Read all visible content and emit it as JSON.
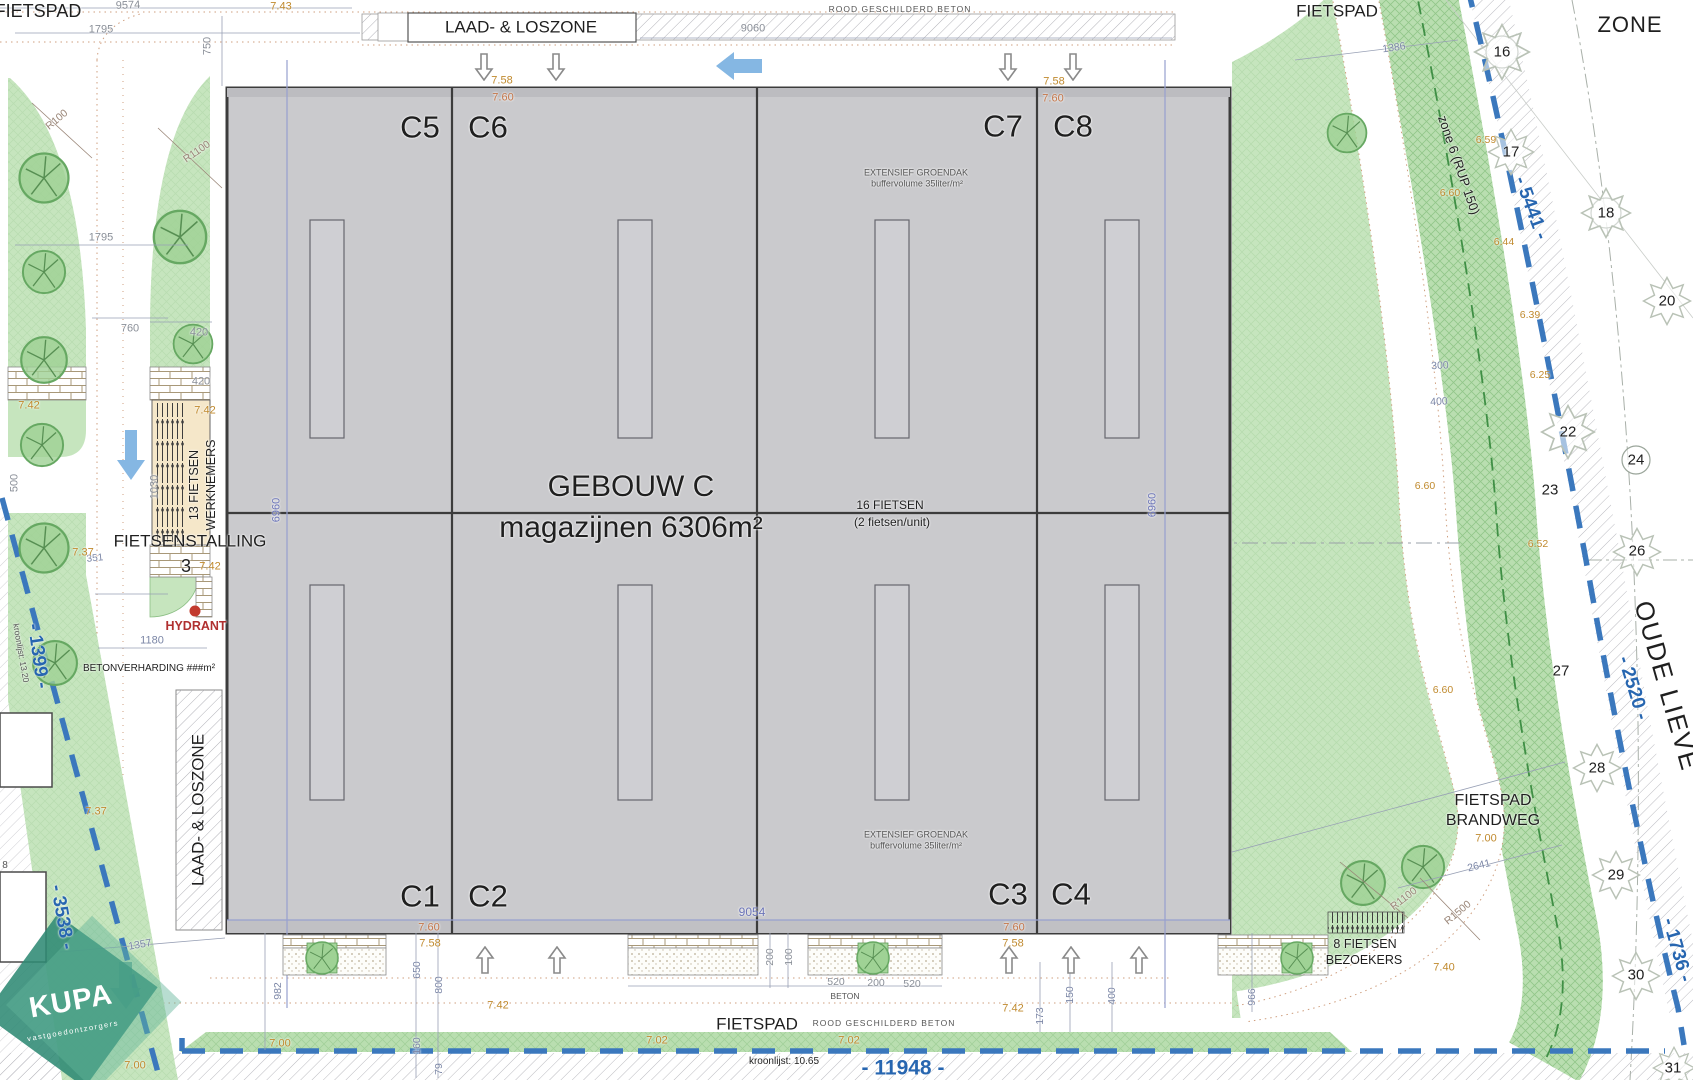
{
  "drawing": {
    "kind": "architectural site plan",
    "building_title": "GEBOUW C",
    "building_subtitle": "magazijnen 6306m²",
    "units": [
      "C1",
      "C2",
      "C3",
      "C4",
      "C5",
      "C6",
      "C7",
      "C8"
    ]
  },
  "colors": {
    "t": "#1f1f1f",
    "g": "#8a8f98",
    "gb": "#7b86a6",
    "b": "#6b74b8",
    "B": "#2766b0",
    "k": "#c08a2e",
    "s": "#c4764a",
    "br": "#9a8678",
    "m": "#555555",
    "r": "#b03030",
    "w": "#ffffff",
    "green_light": "#c6e5be",
    "green_hatch": "#6fb167",
    "boundary_blue": "#3b78bd",
    "building_gray": "#cacacd",
    "arrow_blue": "#85b7e3",
    "kupa_teal": "#2f8a74"
  },
  "labels": [
    {
      "n": "fietspad-top-left",
      "t": "FIETSPAD",
      "x": 38,
      "y": 11,
      "s": 18
    },
    {
      "n": "dim-9574",
      "t": "9574",
      "x": 128,
      "y": 6,
      "s": 11,
      "c": "g",
      "r": -2
    },
    {
      "n": "level-7-43",
      "t": "7.43",
      "x": 281,
      "y": 7,
      "s": 11,
      "c": "k"
    },
    {
      "n": "dim-1795-top",
      "t": "1795",
      "x": 101,
      "y": 30,
      "s": 11,
      "c": "g"
    },
    {
      "n": "dim-750",
      "t": "750",
      "x": 208,
      "y": 46,
      "s": 11,
      "c": "g",
      "r": -90
    },
    {
      "n": "laad-loszone-top",
      "t": "LAAD- & LOSZONE",
      "x": 521,
      "y": 27,
      "s": 17
    },
    {
      "n": "rood-beton-top",
      "t": "ROOD GESCHILDERD BETON",
      "x": 900,
      "y": 9,
      "s": 8.5,
      "c": "m",
      "ls": 1
    },
    {
      "n": "dim-9060",
      "t": "9060",
      "x": 753,
      "y": 29,
      "s": 11,
      "c": "g"
    },
    {
      "n": "fietspad-top-right",
      "t": "FIETSPAD",
      "x": 1337,
      "y": 11,
      "s": 17
    },
    {
      "n": "zone-title",
      "t": "ZONE",
      "x": 1630,
      "y": 25,
      "s": 22,
      "ls": 1
    },
    {
      "n": "dim-1386",
      "t": "1386",
      "x": 1394,
      "y": 48,
      "s": 10.5,
      "c": "gb",
      "r": -8
    },
    {
      "n": "zone6-rup150",
      "t": "zone 6 (RUP 150)",
      "x": 1459,
      "y": 165,
      "s": 13,
      "r": 71
    },
    {
      "n": "dim-5441",
      "t": "- 5441 -",
      "x": 1531,
      "y": 208,
      "s": 19,
      "c": "B",
      "r": 70,
      "w": 700
    },
    {
      "n": "tree-num-16",
      "t": "16",
      "x": 1502,
      "y": 52,
      "s": 15
    },
    {
      "n": "tree-num-17",
      "t": "17",
      "x": 1511,
      "y": 152,
      "s": 15
    },
    {
      "n": "tree-num-18",
      "t": "18",
      "x": 1606,
      "y": 213,
      "s": 15
    },
    {
      "n": "tree-num-20",
      "t": "20",
      "x": 1667,
      "y": 301,
      "s": 15
    },
    {
      "n": "tree-num-22",
      "t": "22",
      "x": 1568,
      "y": 432,
      "s": 15
    },
    {
      "n": "tree-num-23",
      "t": "23",
      "x": 1550,
      "y": 490,
      "s": 15
    },
    {
      "n": "tree-num-24",
      "t": "24",
      "x": 1636,
      "y": 460,
      "s": 15
    },
    {
      "n": "tree-num-26",
      "t": "26",
      "x": 1637,
      "y": 551,
      "s": 15
    },
    {
      "n": "tree-num-27",
      "t": "27",
      "x": 1561,
      "y": 671,
      "s": 15
    },
    {
      "n": "tree-num-28",
      "t": "28",
      "x": 1597,
      "y": 768,
      "s": 15
    },
    {
      "n": "tree-num-29",
      "t": "29",
      "x": 1616,
      "y": 875,
      "s": 15
    },
    {
      "n": "tree-num-30",
      "t": "30",
      "x": 1636,
      "y": 975,
      "s": 15
    },
    {
      "n": "tree-num-31",
      "t": "31",
      "x": 1673,
      "y": 1068,
      "s": 15
    },
    {
      "n": "level-6-59",
      "t": "6.59",
      "x": 1486,
      "y": 140,
      "s": 10.5,
      "c": "k"
    },
    {
      "n": "level-6-60-a",
      "t": "6.60",
      "x": 1450,
      "y": 193,
      "s": 10.5,
      "c": "k"
    },
    {
      "n": "level-6-44",
      "t": "6.44",
      "x": 1504,
      "y": 242,
      "s": 10.5,
      "c": "k"
    },
    {
      "n": "level-6-39",
      "t": "6.39",
      "x": 1530,
      "y": 315,
      "s": 10.5,
      "c": "k"
    },
    {
      "n": "level-6-25",
      "t": "6.25",
      "x": 1540,
      "y": 375,
      "s": 10.5,
      "c": "k"
    },
    {
      "n": "level-6-60-b",
      "t": "6.60",
      "x": 1425,
      "y": 486,
      "s": 10.5,
      "c": "k"
    },
    {
      "n": "level-6-52",
      "t": "6.52",
      "x": 1538,
      "y": 544,
      "s": 10.5,
      "c": "k"
    },
    {
      "n": "level-6-60-c",
      "t": "6.60",
      "x": 1443,
      "y": 690,
      "s": 10.5,
      "c": "k"
    },
    {
      "n": "dim-300",
      "t": "300",
      "x": 1440,
      "y": 366,
      "s": 10.5,
      "c": "gb",
      "r": -3
    },
    {
      "n": "dim-400-right",
      "t": "400",
      "x": 1439,
      "y": 402,
      "s": 10.5,
      "c": "gb",
      "r": -3
    },
    {
      "n": "oude-lieve",
      "t": "OUDE LIEVE",
      "x": 1667,
      "y": 686,
      "s": 26,
      "r": 74,
      "ls": 2
    },
    {
      "n": "dim-2520",
      "t": "- 2520 -",
      "x": 1633,
      "y": 688,
      "s": 19,
      "c": "B",
      "r": 73,
      "w": 700
    },
    {
      "n": "fietspad-brandweg-line1",
      "t": "FIETSPAD",
      "x": 1493,
      "y": 801,
      "s": 16
    },
    {
      "n": "fietspad-brandweg-line2",
      "t": "BRANDWEG",
      "x": 1493,
      "y": 821,
      "s": 16
    },
    {
      "n": "level-7-00-right",
      "t": "7.00",
      "x": 1486,
      "y": 839,
      "s": 11,
      "c": "k"
    },
    {
      "n": "dim-2641",
      "t": "2641",
      "x": 1479,
      "y": 866,
      "s": 10.5,
      "c": "gb",
      "r": -14
    },
    {
      "n": "radius-r1100-b",
      "t": "R1100",
      "x": 1404,
      "y": 899,
      "s": 10.5,
      "c": "br",
      "r": -38
    },
    {
      "n": "radius-r1500",
      "t": "R1500",
      "x": 1458,
      "y": 913,
      "s": 10.5,
      "c": "br",
      "r": -40
    },
    {
      "n": "dim-1736",
      "t": "- 1736 -",
      "x": 1677,
      "y": 950,
      "s": 19,
      "c": "B",
      "r": 74,
      "w": 700
    },
    {
      "n": "level-7-40",
      "t": "7.40",
      "x": 1444,
      "y": 968,
      "s": 11,
      "c": "k"
    },
    {
      "n": "bike-visitors-line1",
      "t": "8 FIETSEN",
      "x": 1365,
      "y": 944,
      "s": 12.5
    },
    {
      "n": "bike-visitors-line2",
      "t": "BEZOEKERS",
      "x": 1364,
      "y": 960,
      "s": 12.5
    },
    {
      "n": "dim-966",
      "t": "966",
      "x": 1252,
      "y": 997,
      "s": 10.5,
      "c": "gb",
      "r": -90
    },
    {
      "n": "unit-c5",
      "t": "C5",
      "x": 420,
      "y": 127,
      "s": 31
    },
    {
      "n": "unit-c6",
      "t": "C6",
      "x": 488,
      "y": 127,
      "s": 31
    },
    {
      "n": "unit-c7",
      "t": "C7",
      "x": 1003,
      "y": 126,
      "s": 31
    },
    {
      "n": "unit-c8",
      "t": "C8",
      "x": 1073,
      "y": 126,
      "s": 31
    },
    {
      "n": "unit-c1",
      "t": "C1",
      "x": 420,
      "y": 896,
      "s": 31
    },
    {
      "n": "unit-c2",
      "t": "C2",
      "x": 488,
      "y": 896,
      "s": 31
    },
    {
      "n": "unit-c3",
      "t": "C3",
      "x": 1008,
      "y": 894,
      "s": 31
    },
    {
      "n": "unit-c4",
      "t": "C4",
      "x": 1071,
      "y": 894,
      "s": 31
    },
    {
      "n": "level-7-58-a",
      "t": "7.58",
      "x": 502,
      "y": 81,
      "s": 11,
      "c": "k"
    },
    {
      "n": "level-7-60-a",
      "t": "7.60",
      "x": 503,
      "y": 98,
      "s": 11,
      "c": "s"
    },
    {
      "n": "level-7-58-b",
      "t": "7.58",
      "x": 1054,
      "y": 82,
      "s": 11,
      "c": "k"
    },
    {
      "n": "level-7-60-b",
      "t": "7.60",
      "x": 1053,
      "y": 99,
      "s": 11,
      "c": "s"
    },
    {
      "n": "level-7-60-c",
      "t": "7.60",
      "x": 429,
      "y": 928,
      "s": 11,
      "c": "s"
    },
    {
      "n": "level-7-58-c",
      "t": "7.58",
      "x": 430,
      "y": 944,
      "s": 11,
      "c": "k"
    },
    {
      "n": "level-7-60-d",
      "t": "7.60",
      "x": 1014,
      "y": 928,
      "s": 11,
      "c": "s"
    },
    {
      "n": "level-7-58-d",
      "t": "7.58",
      "x": 1013,
      "y": 944,
      "s": 11,
      "c": "k"
    },
    {
      "n": "building-title",
      "t": "GEBOUW C",
      "x": 631,
      "y": 487,
      "s": 30
    },
    {
      "n": "building-subtitle",
      "t": "magazijnen 6306m²",
      "x": 631,
      "y": 528,
      "s": 30
    },
    {
      "n": "bikes-16-line1",
      "t": "16 FIETSEN",
      "x": 890,
      "y": 505,
      "s": 12
    },
    {
      "n": "bikes-16-line2",
      "t": "(2 fietsen/unit)",
      "x": 892,
      "y": 522,
      "s": 12
    },
    {
      "n": "groendak-top-line1",
      "t": "EXTENSIEF GROENDAK",
      "x": 916,
      "y": 173,
      "s": 9,
      "c": "m"
    },
    {
      "n": "groendak-top-line2",
      "t": "buffervolume 35liter/m²",
      "x": 917,
      "y": 184,
      "s": 9,
      "c": "m"
    },
    {
      "n": "groendak-bottom-line1",
      "t": "EXTENSIEF GROENDAK",
      "x": 916,
      "y": 835,
      "s": 9,
      "c": "m"
    },
    {
      "n": "groendak-bottom-line2",
      "t": "buffervolume 35liter/m²",
      "x": 916,
      "y": 846,
      "s": 9,
      "c": "m"
    },
    {
      "n": "dim-9054",
      "t": "9054",
      "x": 752,
      "y": 912,
      "s": 12,
      "c": "b"
    },
    {
      "n": "dim-6960-left",
      "t": "6960",
      "x": 277,
      "y": 510,
      "s": 11,
      "c": "b",
      "r": -90
    },
    {
      "n": "dim-6960-right",
      "t": "6960",
      "x": 1153,
      "y": 505,
      "s": 11,
      "c": "b",
      "r": -90
    },
    {
      "n": "dim-1795-left",
      "t": "1795",
      "x": 101,
      "y": 238,
      "s": 11,
      "c": "g"
    },
    {
      "n": "dim-760-a",
      "t": "760",
      "x": 130,
      "y": 329,
      "s": 11,
      "c": "g"
    },
    {
      "n": "dim-420-a",
      "t": "420",
      "x": 199,
      "y": 333,
      "s": 11,
      "c": "g"
    },
    {
      "n": "level-7-42-a",
      "t": "7.42",
      "x": 29,
      "y": 406,
      "s": 11,
      "c": "k"
    },
    {
      "n": "level-7-42-b",
      "t": "7.42",
      "x": 205,
      "y": 411,
      "s": 11,
      "c": "k"
    },
    {
      "n": "dim-420-b",
      "t": "420",
      "x": 201,
      "y": 382,
      "s": 11,
      "c": "g"
    },
    {
      "n": "dim-500",
      "t": "500",
      "x": 15,
      "y": 483,
      "s": 11,
      "c": "g",
      "r": -90
    },
    {
      "n": "dim-1030",
      "t": "1030",
      "x": 155,
      "y": 487,
      "s": 11,
      "c": "g",
      "r": -90
    },
    {
      "n": "dim-351",
      "t": "351",
      "x": 95,
      "y": 559,
      "s": 10,
      "c": "gb",
      "r": -6
    },
    {
      "n": "level-7-37-a",
      "t": "7.37",
      "x": 83,
      "y": 553,
      "s": 11,
      "c": "k"
    },
    {
      "n": "fietsenstalling",
      "t": "FIETSENSTALLING",
      "x": 190,
      "y": 541,
      "s": 17
    },
    {
      "n": "stalling-count",
      "t": "3",
      "x": 186,
      "y": 566,
      "s": 18
    },
    {
      "n": "level-7-42-c",
      "t": "7.42",
      "x": 210,
      "y": 567,
      "s": 11,
      "c": "k"
    },
    {
      "n": "hydrant-label",
      "t": "HYDRANT",
      "x": 196,
      "y": 626,
      "s": 12.5,
      "c": "r",
      "w": 600
    },
    {
      "n": "dim-1180",
      "t": "1180",
      "x": 152,
      "y": 641,
      "s": 11,
      "c": "gb"
    },
    {
      "n": "betonverharding",
      "t": "BETONVERHARDING ###m²",
      "x": 149,
      "y": 669,
      "s": 10
    },
    {
      "n": "radius-r100",
      "t": "R100",
      "x": 57,
      "y": 120,
      "s": 10.5,
      "c": "br",
      "r": -40
    },
    {
      "n": "radius-r1100-a",
      "t": "R1100",
      "x": 197,
      "y": 152,
      "s": 10.5,
      "c": "br",
      "r": -35
    },
    {
      "n": "level-7-37-b",
      "t": "7.37",
      "x": 96,
      "y": 812,
      "s": 11,
      "c": "k"
    },
    {
      "n": "laad-loszone-left",
      "t": "LAAD- & LOSZONE",
      "x": 198,
      "y": 810,
      "s": 17,
      "r": -90
    },
    {
      "n": "bike-workers-line1",
      "t": "13 FIETSEN",
      "x": 194,
      "y": 485,
      "s": 12.5,
      "r": -90
    },
    {
      "n": "bike-workers-line2",
      "t": "WERKNEMERS",
      "x": 211,
      "y": 485,
      "s": 12.5,
      "r": -90
    },
    {
      "n": "dim-1399",
      "t": "- 1399 -",
      "x": 38,
      "y": 656,
      "s": 19,
      "c": "B",
      "r": 82,
      "w": 700
    },
    {
      "n": "kroonlijst-13-20",
      "t": "kroonlijst: 13.20",
      "x": 21,
      "y": 653,
      "s": 8.5,
      "c": "m",
      "r": 80
    },
    {
      "n": "dim-3538",
      "t": "- 3538 -",
      "x": 62,
      "y": 917,
      "s": 19,
      "c": "B",
      "r": 80,
      "w": 700
    },
    {
      "n": "parcel-8",
      "t": "8",
      "x": 5,
      "y": 866,
      "s": 10,
      "c": "m"
    },
    {
      "n": "kupa-logo-text",
      "t": "KUPA",
      "x": 71,
      "y": 1002,
      "s": 29,
      "c": "w",
      "r": -10,
      "w": 700,
      "ls": 1
    },
    {
      "n": "kupa-logo-sub",
      "t": "vastgoedontzorgers",
      "x": 73,
      "y": 1031,
      "s": 7.5,
      "c": "w",
      "r": -10,
      "ls": 1.5
    },
    {
      "n": "dim-1357",
      "t": "1357",
      "x": 140,
      "y": 945,
      "s": 10.5,
      "c": "gb",
      "r": -10
    },
    {
      "n": "dim-982",
      "t": "982",
      "x": 278,
      "y": 991,
      "s": 10.5,
      "c": "gb",
      "r": -90
    },
    {
      "n": "dim-650",
      "t": "650",
      "x": 417,
      "y": 970,
      "s": 10.5,
      "c": "gb",
      "r": -90
    },
    {
      "n": "dim-800",
      "t": "800",
      "x": 439,
      "y": 985,
      "s": 10.5,
      "c": "gb",
      "r": -90
    },
    {
      "n": "dim-160",
      "t": "160",
      "x": 417,
      "y": 1046,
      "s": 10.5,
      "c": "gb",
      "r": -90
    },
    {
      "n": "dim-79",
      "t": "79",
      "x": 439,
      "y": 1069,
      "s": 10.5,
      "c": "gb",
      "r": -90
    },
    {
      "n": "level-7-00-a",
      "t": "7.00",
      "x": 280,
      "y": 1044,
      "s": 11,
      "c": "k"
    },
    {
      "n": "level-7-00-b",
      "t": "7.00",
      "x": 135,
      "y": 1066,
      "s": 11,
      "c": "k"
    },
    {
      "n": "level-7-42-d",
      "t": "7.42",
      "x": 498,
      "y": 1006,
      "s": 11,
      "c": "k"
    },
    {
      "n": "level-7-42-e",
      "t": "7.42",
      "x": 1013,
      "y": 1009,
      "s": 11,
      "c": "k"
    },
    {
      "n": "level-7-02-a",
      "t": "7.02",
      "x": 657,
      "y": 1041,
      "s": 11,
      "c": "k"
    },
    {
      "n": "level-7-02-b",
      "t": "7.02",
      "x": 849,
      "y": 1041,
      "s": 11,
      "c": "k"
    },
    {
      "n": "dim-520-a",
      "t": "520",
      "x": 836,
      "y": 982,
      "s": 10.5,
      "c": "g"
    },
    {
      "n": "dim-200-a",
      "t": "200",
      "x": 876,
      "y": 983,
      "s": 10.5,
      "c": "g"
    },
    {
      "n": "dim-520-b",
      "t": "520",
      "x": 912,
      "y": 984,
      "s": 10.5,
      "c": "g"
    },
    {
      "n": "beton-small",
      "t": "BETON",
      "x": 845,
      "y": 996,
      "s": 8.5,
      "c": "m"
    },
    {
      "n": "dim-200-rot",
      "t": "200",
      "x": 770,
      "y": 957,
      "s": 10.5,
      "c": "g",
      "r": -90
    },
    {
      "n": "dim-100-rot",
      "t": "100",
      "x": 789,
      "y": 957,
      "s": 10.5,
      "c": "g",
      "r": -90
    },
    {
      "n": "dim-173",
      "t": "173",
      "x": 1040,
      "y": 1016,
      "s": 10.5,
      "c": "gb",
      "r": -90
    },
    {
      "n": "dim-150",
      "t": "150",
      "x": 1070,
      "y": 995,
      "s": 10.5,
      "c": "gb",
      "r": -90
    },
    {
      "n": "dim-400-bottom",
      "t": "400",
      "x": 1112,
      "y": 996,
      "s": 10.5,
      "c": "gb",
      "r": -90
    },
    {
      "n": "fietspad-bottom",
      "t": "FIETSPAD",
      "x": 757,
      "y": 1024,
      "s": 17
    },
    {
      "n": "rood-beton-bottom",
      "t": "ROOD GESCHILDERD BETON",
      "x": 884,
      "y": 1023,
      "s": 8.5,
      "c": "m",
      "ls": 1
    },
    {
      "n": "kroonlijst-10-65",
      "t": "kroonlijst: 10.65",
      "x": 784,
      "y": 1062,
      "s": 10
    },
    {
      "n": "dim-11948",
      "t": "- 11948 -",
      "x": 903,
      "y": 1068,
      "s": 21,
      "c": "B",
      "w": 700
    }
  ]
}
